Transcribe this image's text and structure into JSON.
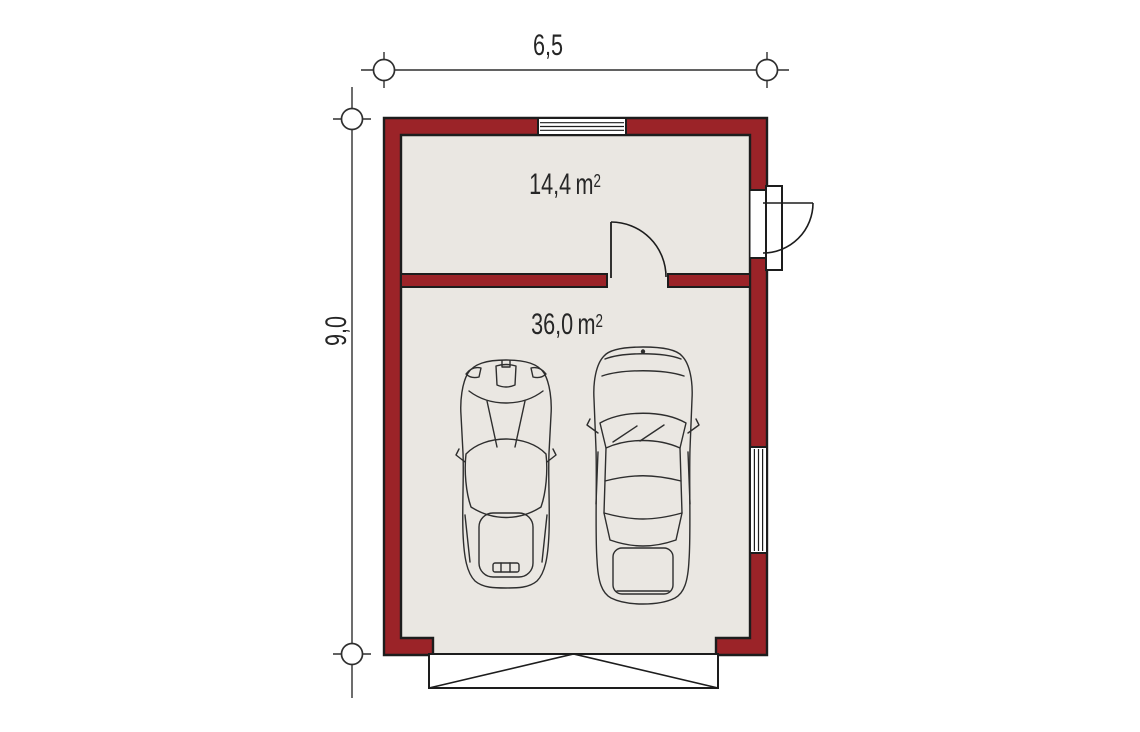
{
  "colors": {
    "paper": "#ffffff",
    "wall": "#9b2328",
    "floor": "#eae7e2",
    "line": "#1d1d1d",
    "dim": "#2f2f2f",
    "text": "#262626",
    "opening": "#ffffff"
  },
  "dimensions": {
    "width": {
      "label": "6,5"
    },
    "height": {
      "label": "9,0"
    }
  },
  "rooms": [
    {
      "id": "utility-room",
      "area": "14,4",
      "unit": "m",
      "exponent": "2"
    },
    {
      "id": "garage",
      "area": "36,0",
      "unit": "m",
      "exponent": "2"
    }
  ],
  "icons": {
    "top_window": "window-icon",
    "side_window": "window-icon",
    "entry_door": "exterior-door-swing-icon",
    "interior_door": "interior-door-swing-icon",
    "garage_door": "garage-door-panel-icon",
    "car_left": "sports-car-top-view-icon",
    "car_right": "sedan-car-top-view-icon",
    "dim_marker": "dimension-circle-marker-icon"
  }
}
